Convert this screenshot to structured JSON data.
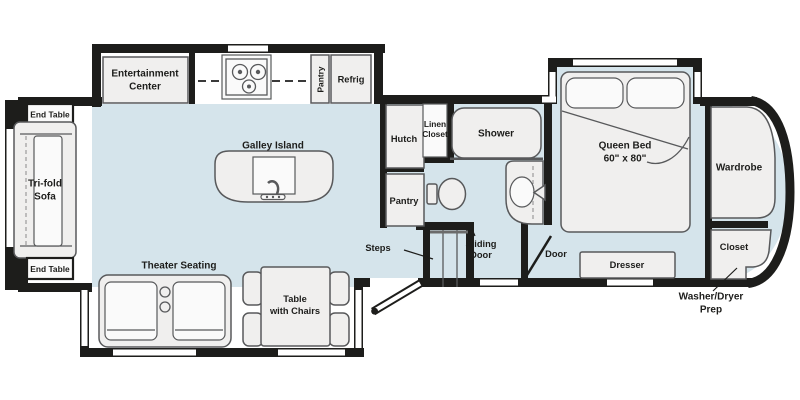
{
  "floorplan": {
    "type": "RV fifth-wheel floor plan",
    "colors": {
      "wall": "#1d1d1b",
      "floor": "#d5e4eb",
      "slide_floor": "#ffffff",
      "furniture": "#f0efee",
      "furniture_outline": "#58595b",
      "label_text": "#1d1d1b"
    },
    "labels": {
      "end_table_top": "End Table",
      "end_table_bottom": "End Table",
      "tri_fold_1": "Tri-fold",
      "tri_fold_2": "Sofa",
      "entertainment_1": "Entertainment",
      "entertainment_2": "Center",
      "galley_island": "Galley Island",
      "pantry_kitchen": "Pantry",
      "refrig": "Refrig",
      "hutch": "Hutch",
      "linen_1": "Linen",
      "linen_2": "Closet",
      "shower": "Shower",
      "pantry_hall": "Pantry",
      "steps": "Steps",
      "sliding_door_1": "Sliding",
      "sliding_door_2": "Door",
      "door": "Door",
      "queen_bed_1": "Queen Bed",
      "queen_bed_2": "60\" x 80\"",
      "wardrobe": "Wardrobe",
      "dresser": "Dresser",
      "closet": "Closet",
      "washer_dryer_1": "Washer/Dryer",
      "washer_dryer_2": "Prep",
      "theater_seating": "Theater Seating",
      "table_1": "Table",
      "table_2": "with Chairs"
    }
  }
}
